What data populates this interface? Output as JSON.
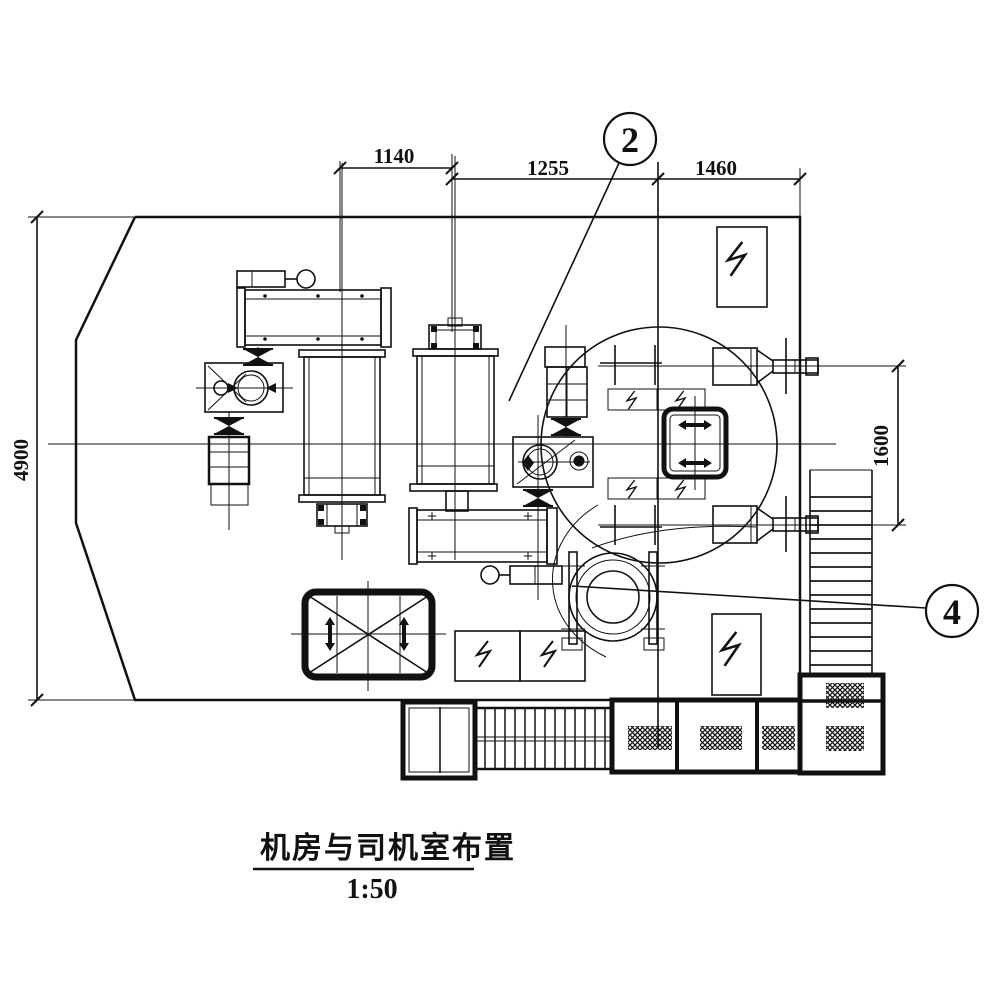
{
  "drawing": {
    "title": "机房与司机室布置",
    "scale_label": "1:50",
    "callouts": {
      "c2": "2",
      "c4": "4"
    },
    "dimensions": {
      "d1140": "1140",
      "d1255": "1255",
      "d1460": "1460",
      "d4900": "4900",
      "d1600": "1600"
    },
    "line_color": "#111111",
    "background": "#ffffff"
  }
}
